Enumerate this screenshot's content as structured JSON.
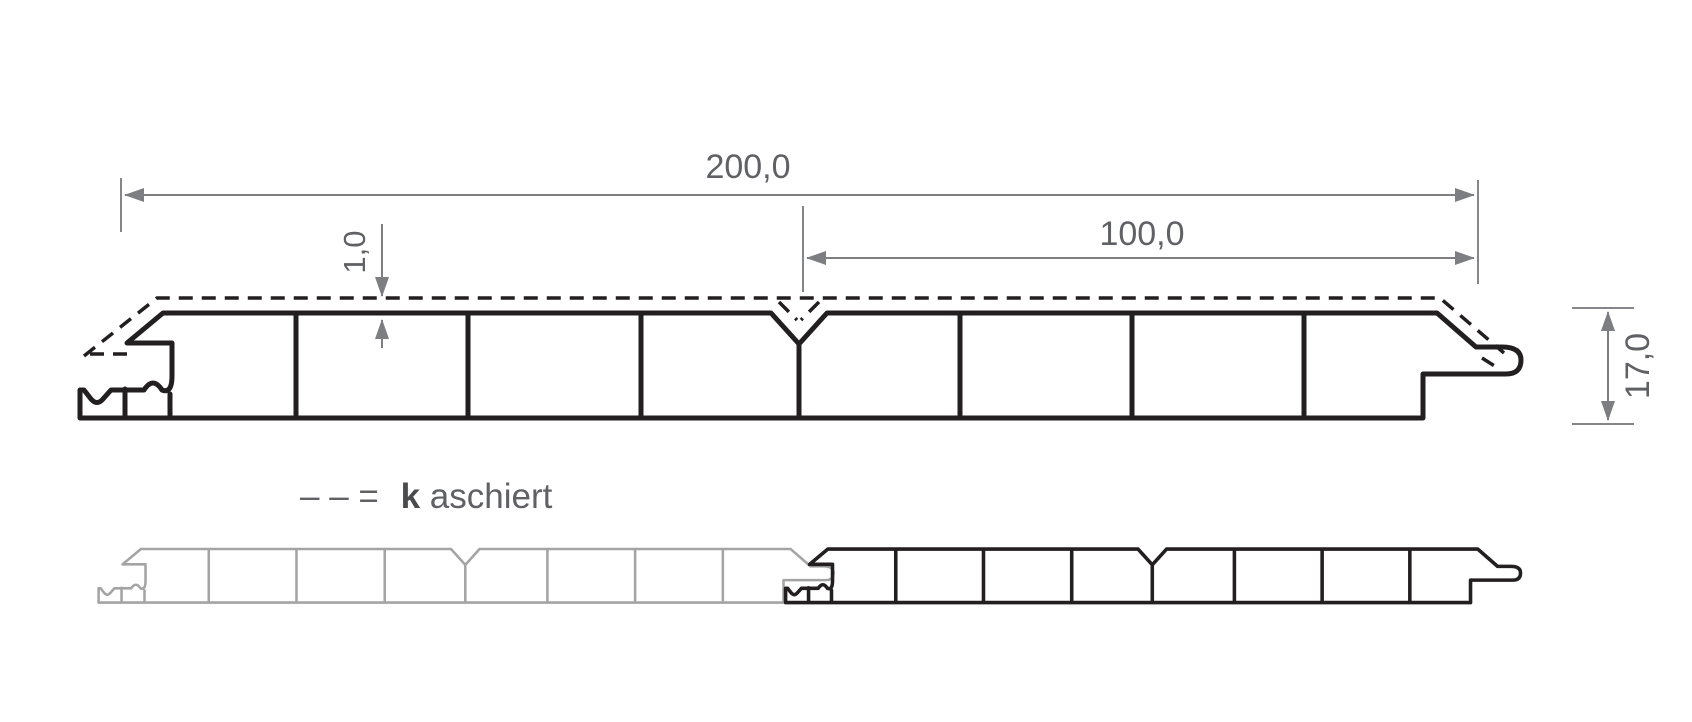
{
  "drawing": {
    "dimensions": {
      "total_width": "200,0",
      "half_width": "100,0",
      "laminate_thickness": "1,0",
      "panel_height": "17,0"
    },
    "legend": {
      "symbol": "– – =",
      "label_bold": "k",
      "label_rest": "aschiert"
    },
    "colors": {
      "outline": "#231f20",
      "faded_panel": "#a4a4a4",
      "dimension_lines": "#7d7e81",
      "dimension_text": "#606165",
      "background": "#ffffff"
    }
  }
}
